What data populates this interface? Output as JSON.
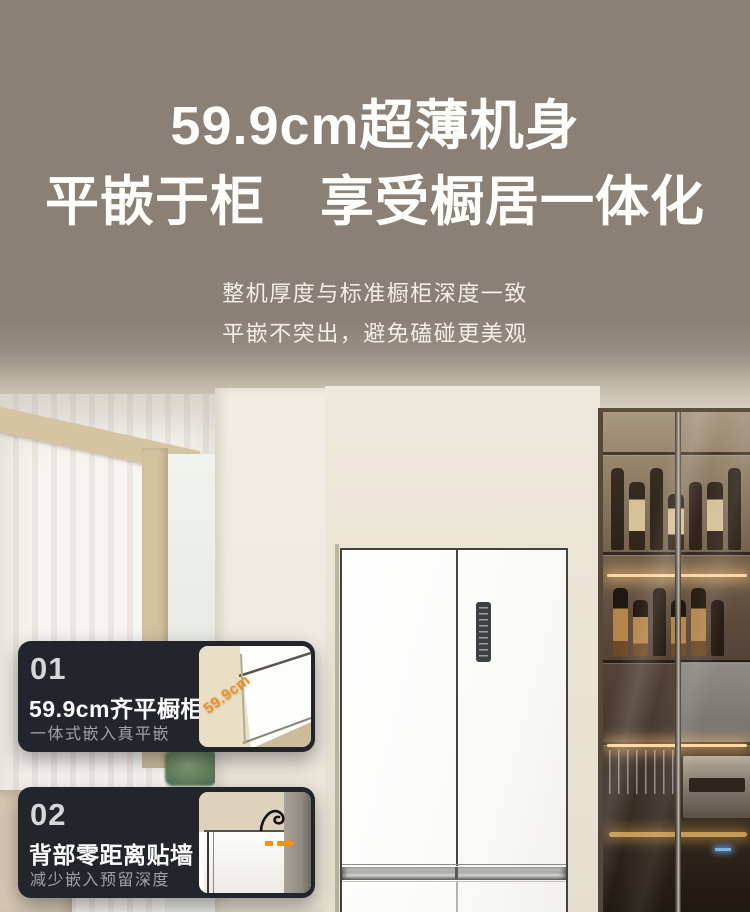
{
  "hero": {
    "title_line1": "59.9cm超薄机身",
    "title_line2": "平嵌于柜　享受橱居一体化",
    "subtitle_line1": "整机厚度与标准橱柜深度一致",
    "subtitle_line2": "平嵌不突出，避免磕碰更美观"
  },
  "features": [
    {
      "index": "01",
      "title": "59.9cm齐平橱柜",
      "subtitle": "一体式嵌入真平嵌",
      "thumb_label": "59.9cm"
    },
    {
      "index": "02",
      "title": "背部零距离贴墙",
      "subtitle": "减少嵌入预留深度"
    }
  ],
  "colors": {
    "background_taupe": "#8a8075",
    "card_background": "#23252c",
    "accent_orange": "#f18f1c",
    "heading_text": "#fdfdfb",
    "card_subtitle_text": "#9da2a9",
    "cabinet_cream": "#ebe4d5",
    "glass_cabinet_bronze": "#57463a"
  }
}
